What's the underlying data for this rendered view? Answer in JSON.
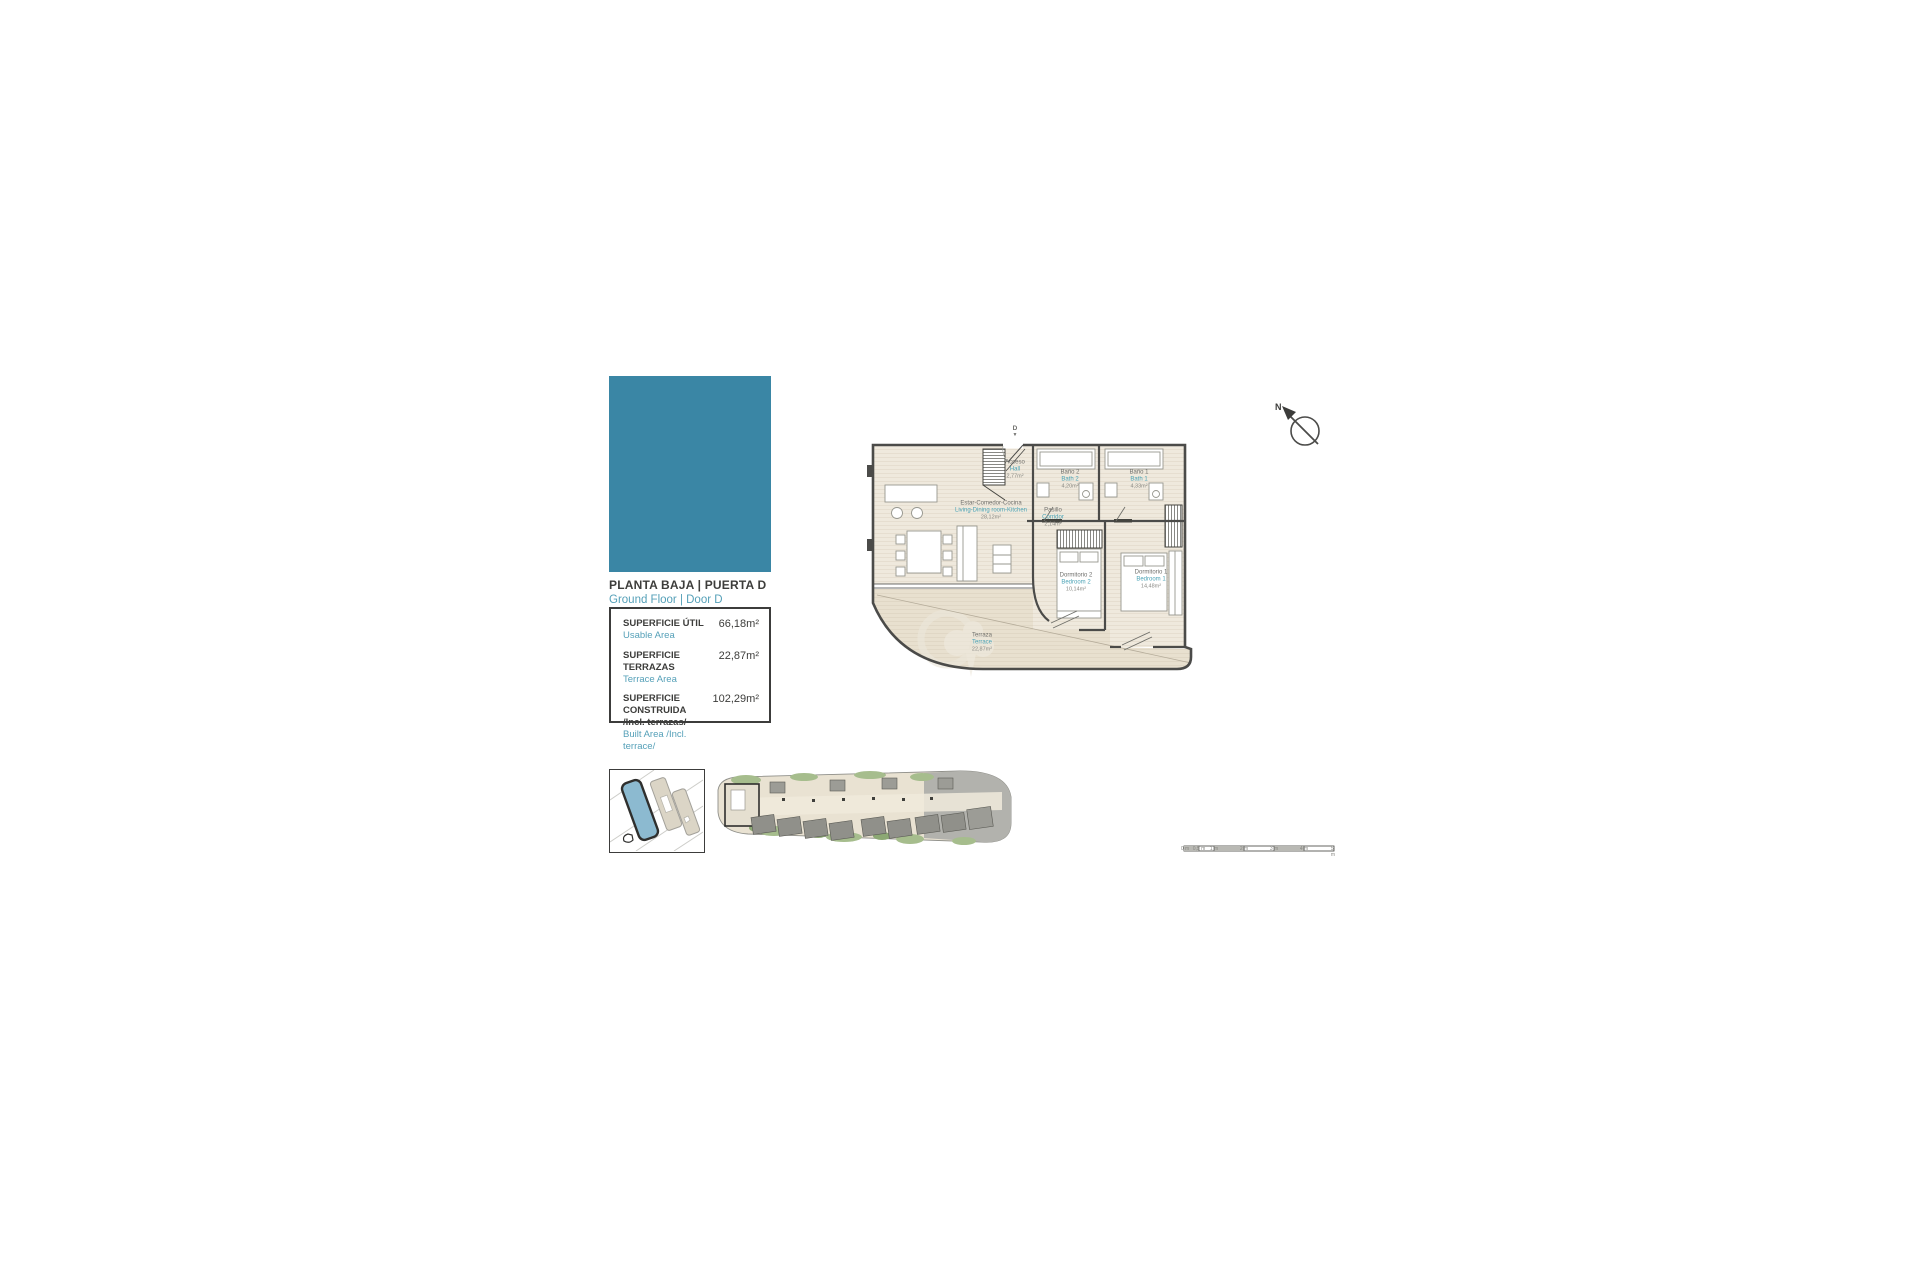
{
  "header": {
    "title_es": "PLANTA BAJA | PUERTA D",
    "title_en": "Ground Floor | Door D"
  },
  "colors": {
    "accent": "#3a86a5",
    "teal_text": "#55a0b8",
    "dark_text": "#3d3d3b"
  },
  "areas": {
    "rows": [
      {
        "label_es": "SUPERFICIE ÚTIL",
        "label_es2": "",
        "label_en": "Usable Area",
        "value": "66,18m²"
      },
      {
        "label_es": "SUPERFICIE TERRAZAS",
        "label_es2": "",
        "label_en": "Terrace Area",
        "value": "22,87m²"
      },
      {
        "label_es": "SUPERFICIE CONSTRUIDA",
        "label_es2": "/Incl. terrazas/",
        "label_en": "Built Area /Incl. terrace/",
        "value": "102,29m²"
      }
    ]
  },
  "plan": {
    "entrance_label": "D",
    "entrance_arrow": "▼",
    "rooms": [
      {
        "es": "Acceso",
        "en": "Hall",
        "area": "2,77m²"
      },
      {
        "es": "Baño 2",
        "en": "Bath 2",
        "area": "4,20m²"
      },
      {
        "es": "Baño 1",
        "en": "Bath 1",
        "area": "4,33m²"
      },
      {
        "es": "Estar-Comedor-Cocina",
        "en": "Living-Dining room-Kitchen",
        "area": "28,12m²"
      },
      {
        "es": "Pasillo",
        "en": "Corridor",
        "area": "2,14m²"
      },
      {
        "es": "Dormitorio 2",
        "en": "Bedroom 2",
        "area": "10,14m²"
      },
      {
        "es": "Dormitorio 1",
        "en": "Bedroom 1",
        "area": "14,48m²"
      },
      {
        "es": "Terraza",
        "en": "Terrace",
        "area": "22,87m²"
      }
    ]
  },
  "compass": {
    "label": "N"
  },
  "scalebar": {
    "labels": [
      "0 m",
      "0,5 m",
      "1 m",
      "2 m",
      "3 m",
      "4 m",
      "5 m"
    ]
  }
}
